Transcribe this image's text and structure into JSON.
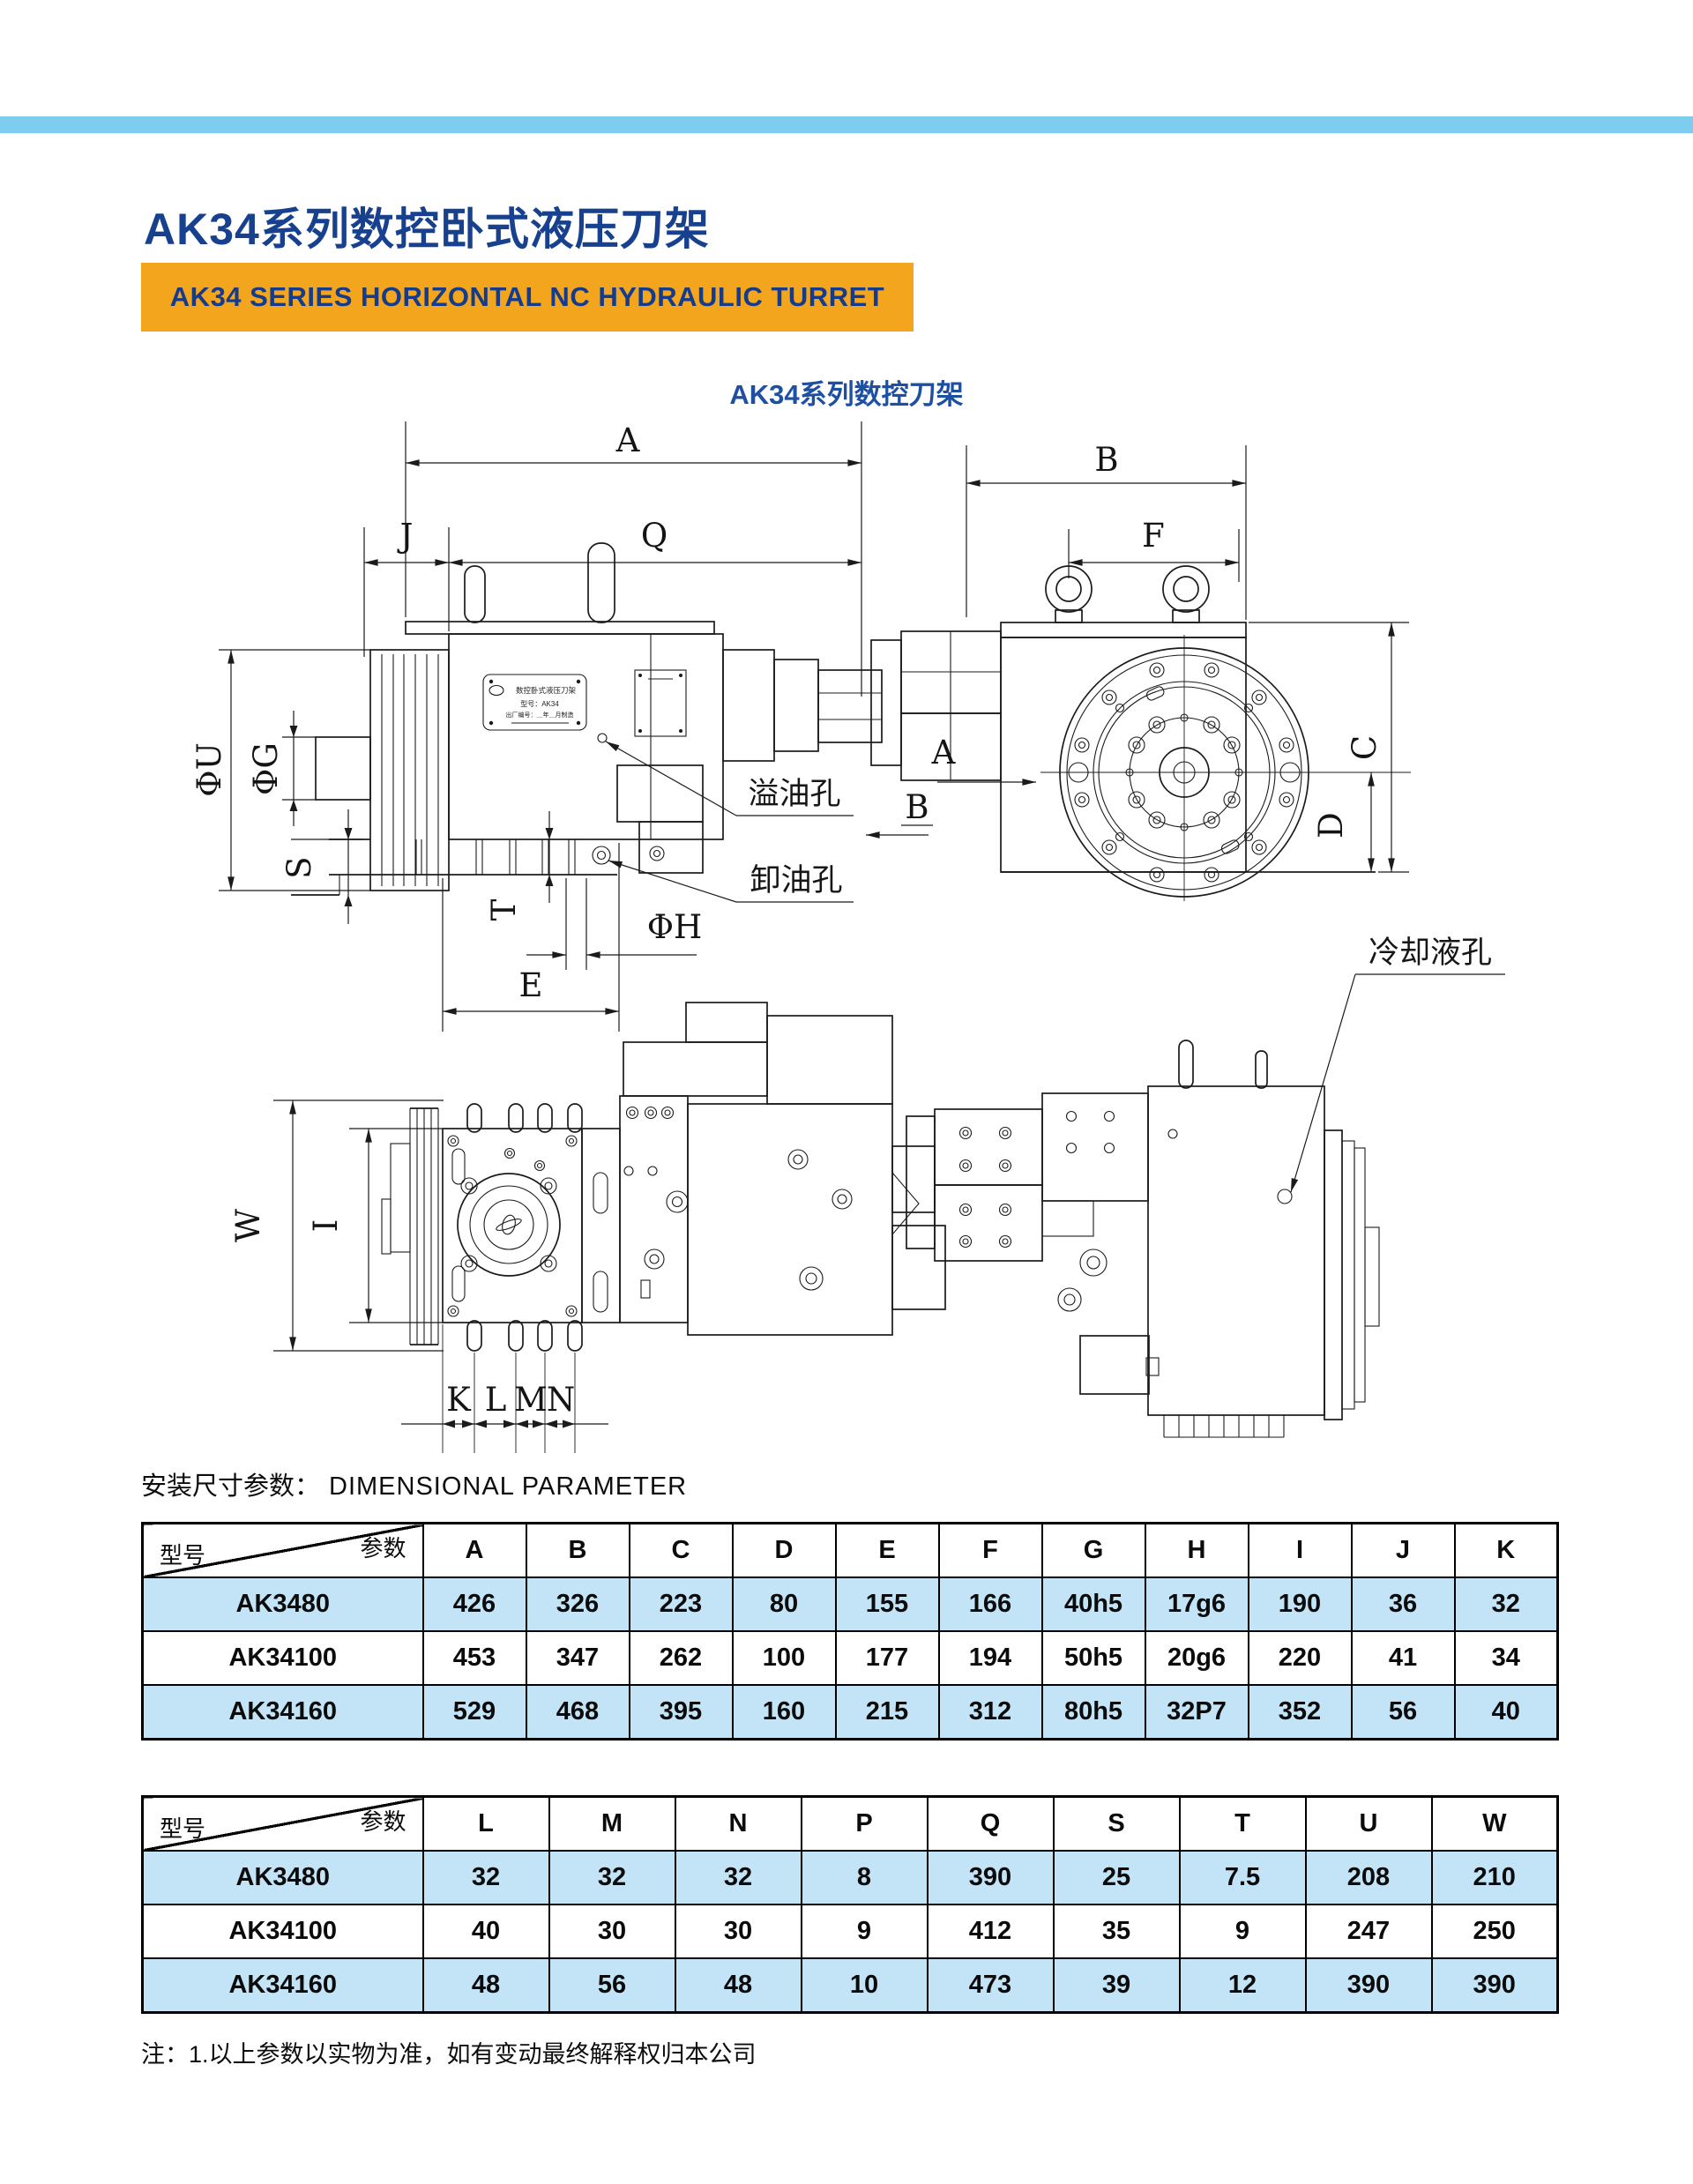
{
  "page": {
    "title": "AK34系列数控卧式液压刀架",
    "banner": "AK34 SERIES HORIZONTAL NC HYDRAULIC TURRET",
    "subtitle": "AK34系列数控刀架",
    "section_label_cn": "安装尺寸参数：",
    "section_label_en": "DIMENSIONAL PARAMETER",
    "note": "注：1.以上参数以实物为准，如有变动最终解释权归本公司"
  },
  "colors": {
    "top_bar": "#7ccdf0",
    "title_blue": "#17418f",
    "banner_orange": "#f3a61d",
    "table_row_blue": "#c2e4f6",
    "line_black": "#1b1b1b"
  },
  "drawing": {
    "dims": {
      "A": "A",
      "B": "B",
      "C": "C",
      "D": "D",
      "E": "E",
      "F": "F",
      "J": "J",
      "Q": "Q",
      "K": "K",
      "L": "L",
      "M": "M",
      "N": "N",
      "S": "S",
      "T": "T",
      "W": "W",
      "I": "I",
      "phiU": "ΦU",
      "phiG": "ΦG",
      "phiH": "ΦH"
    },
    "views": {
      "a": "A",
      "b": "B"
    },
    "annotations": {
      "overflow_hole": "溢油孔",
      "drain_hole": "卸油孔",
      "coolant_hole": "冷却液孔"
    },
    "nameplate": {
      "line1": "数控卧式液压刀架",
      "line2": "型号：AK34",
      "line3": "出厂编号：＿年＿月制造"
    }
  },
  "tables": {
    "corner": {
      "param": "参数",
      "model": "型号"
    },
    "table1": {
      "headers": [
        "A",
        "B",
        "C",
        "D",
        "E",
        "F",
        "G",
        "H",
        "I",
        "J",
        "K"
      ],
      "rows": [
        {
          "model": "AK3480",
          "values": [
            "426",
            "326",
            "223",
            "80",
            "155",
            "166",
            "40h5",
            "17g6",
            "190",
            "36",
            "32"
          ]
        },
        {
          "model": "AK34100",
          "values": [
            "453",
            "347",
            "262",
            "100",
            "177",
            "194",
            "50h5",
            "20g6",
            "220",
            "41",
            "34"
          ]
        },
        {
          "model": "AK34160",
          "values": [
            "529",
            "468",
            "395",
            "160",
            "215",
            "312",
            "80h5",
            "32P7",
            "352",
            "56",
            "40"
          ]
        }
      ]
    },
    "table2": {
      "headers": [
        "L",
        "M",
        "N",
        "P",
        "Q",
        "S",
        "T",
        "U",
        "W"
      ],
      "rows": [
        {
          "model": "AK3480",
          "values": [
            "32",
            "32",
            "32",
            "8",
            "390",
            "25",
            "7.5",
            "208",
            "210"
          ]
        },
        {
          "model": "AK34100",
          "values": [
            "40",
            "30",
            "30",
            "9",
            "412",
            "35",
            "9",
            "247",
            "250"
          ]
        },
        {
          "model": "AK34160",
          "values": [
            "48",
            "56",
            "48",
            "10",
            "473",
            "39",
            "12",
            "390",
            "390"
          ]
        }
      ]
    }
  }
}
